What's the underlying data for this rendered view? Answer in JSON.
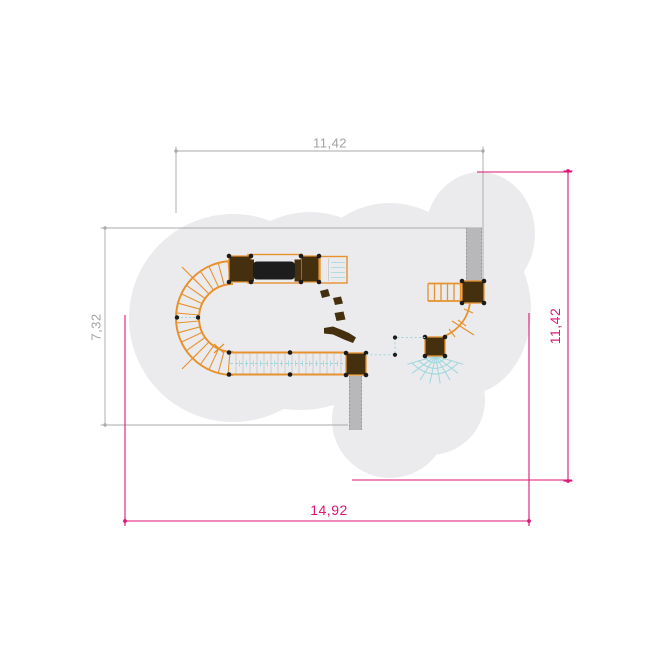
{
  "drawing": {
    "kind": "playground-equipment-plan-view",
    "dimensions": {
      "top": {
        "label": "11,42",
        "orientation": "horizontal",
        "color_role": "gray"
      },
      "left": {
        "label": "7,32",
        "orientation": "vertical",
        "color_role": "gray"
      },
      "right": {
        "label": "11,42",
        "orientation": "vertical",
        "color_role": "magenta"
      },
      "bottom": {
        "label": "14,92",
        "orientation": "horizontal",
        "color_role": "magenta"
      }
    },
    "components": [
      "safety-area-outline",
      "curved-ramp",
      "crawl-tunnel",
      "platforms",
      "grid-platform",
      "rope-bridge",
      "stepping-stones",
      "balance-beam",
      "slide-top-right",
      "slide-bottom",
      "ladder",
      "curved-walkway",
      "climbing-net",
      "rope-connector"
    ]
  },
  "colors": {
    "c-orange": "#e6922f",
    "c-brown": "#44300e",
    "c-tunnel": "#1d1d1d",
    "c-blob": "#ebebed",
    "c-slide": "#b8b8bb",
    "c-slide-edge": "#97979b",
    "c-net": "#9ed6de",
    "c-slat": "#c6c6c6",
    "c-dimgray": "#a9a9a9",
    "c-dimtext": "#a2a2a2",
    "c-magenta": "#dd1677",
    "c-paper": "#ffffff"
  }
}
